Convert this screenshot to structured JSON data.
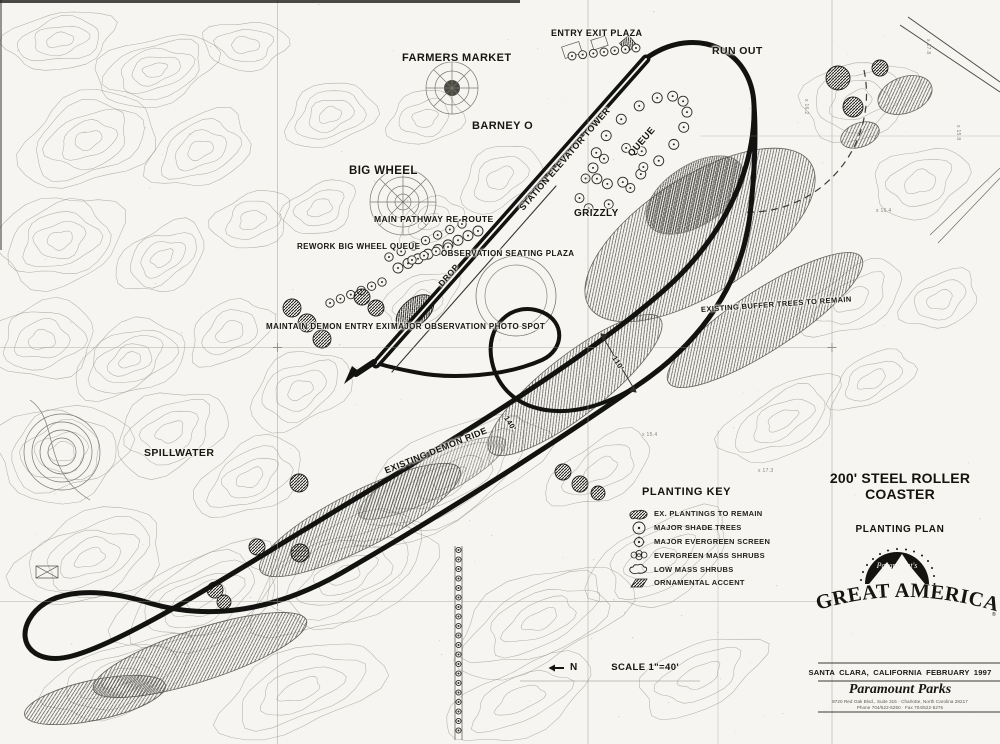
{
  "plan_labels": {
    "entry_exit_plaza": "ENTRY EXIT PLAZA",
    "run_out": "RUN OUT",
    "farmers_market": "FARMERS MARKET",
    "barney_o": "BARNEY O",
    "big_wheel": "BIG WHEEL",
    "station_elevator_tower": "STATION ELEVATOR TOWER",
    "queue": "QUEUE",
    "grizzly": "GRIZZLY",
    "main_pathway_reroute": "MAIN PATHWAY RE-ROUTE",
    "rework_big_wheel_queue": "REWORK BIG WHEEL QUEUE",
    "observation_seating_plaza": "OBSERVATION SEATING PLAZA",
    "drop": "DROP",
    "maintain_demon_entry_exit": "MAINTAIN DEMON ENTRY EXIT",
    "major_observation_photo_spot": "MAJOR OBSERVATION PHOTO SPOT",
    "existing_buffer_trees": "EXISTING BUFFER TREES TO REMAIN",
    "spillwater": "SPILLWATER",
    "existing_demon_ride": "EXISTING DEMON RIDE",
    "dim_110": "110'",
    "dim_140": "140'"
  },
  "spot_elevations": [
    "x 17.8",
    "x 15.8",
    "x 16.4",
    "x 15.4",
    "x 17.3",
    "x 16.2"
  ],
  "legend": {
    "title": "PLANTING KEY",
    "items": [
      {
        "symbol": "ex-plantings-blob",
        "label": "EX. PLANTINGS TO REMAIN"
      },
      {
        "symbol": "shade-tree-circle",
        "label": "MAJOR SHADE TREES"
      },
      {
        "symbol": "evergreen-screen-circle",
        "label": "MAJOR EVERGREEN SCREEN"
      },
      {
        "symbol": "evergreen-mass-cluster",
        "label": "EVERGREEN MASS SHRUBS"
      },
      {
        "symbol": "low-mass-cloud",
        "label": "LOW MASS SHRUBS"
      },
      {
        "symbol": "ornamental-hatch",
        "label": "ORNAMENTAL ACCENT"
      }
    ]
  },
  "title_block": {
    "project_title": "200' STEEL ROLLER COASTER",
    "sheet_title": "PLANTING PLAN",
    "logo_script": "Paramount's",
    "logo_name": "GREAT AMERICA",
    "registered_mark": "®",
    "location_date": "SANTA CLARA, CALIFORNIA  FEBRUARY 1997",
    "company": "Paramount Parks",
    "address_line1": "8720 Red Oak Blvd., Suite 315 · Charlotte, North Carolina 28217",
    "address_line2": "Phone 704/522-5250 · Fax 704/522-5276"
  },
  "scale_north": {
    "north": "N",
    "scale": "SCALE 1\"=40'"
  }
}
